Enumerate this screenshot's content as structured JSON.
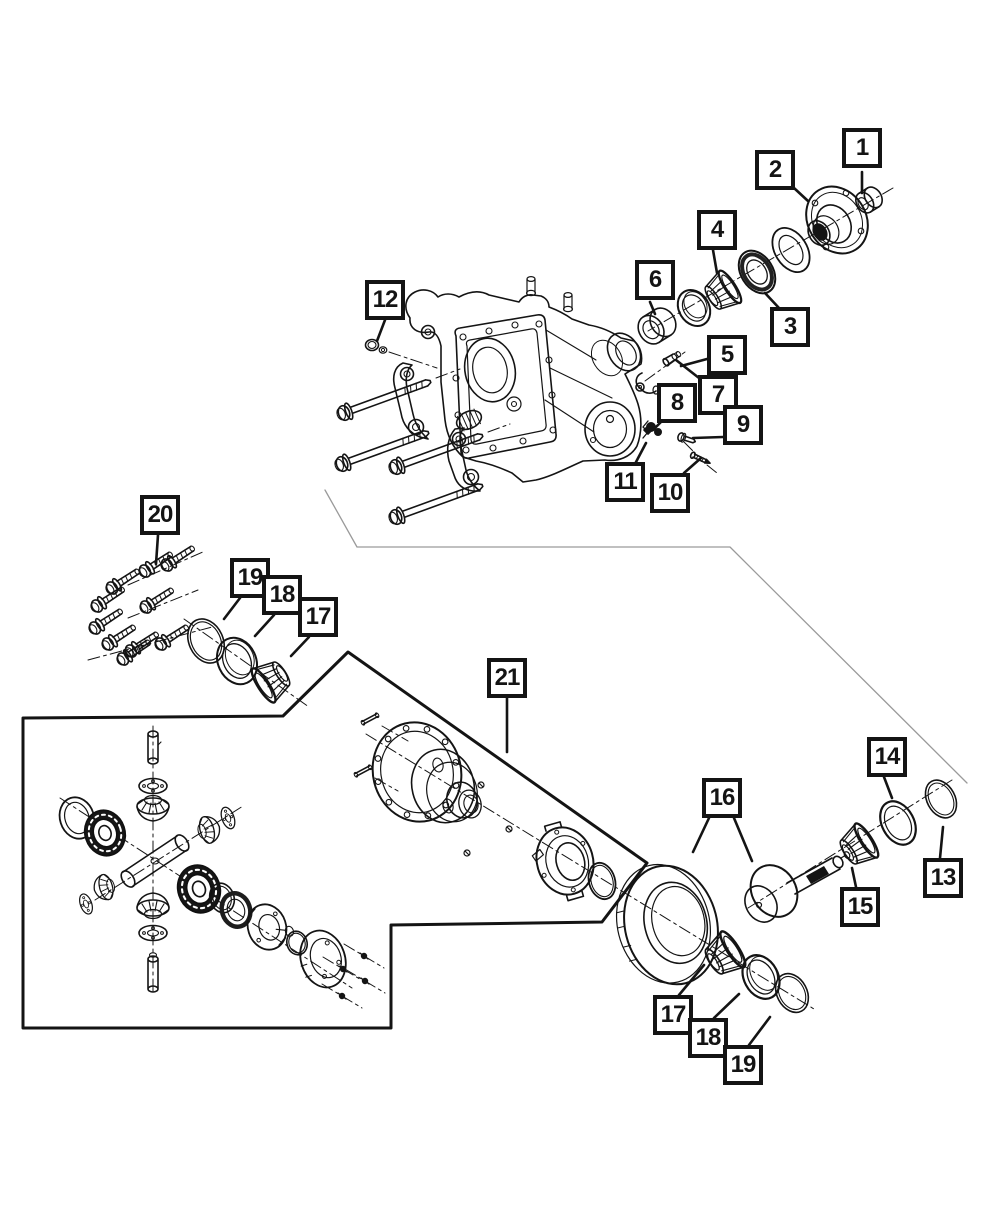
{
  "diagram": {
    "type": "exploded-parts-diagram",
    "canvas": {
      "width": 1000,
      "height": 1214
    },
    "colors": {
      "paper": "#ffffff",
      "ink": "#141414",
      "divider": "#9a9a9a"
    },
    "callout_numbers_visible": [
      "1",
      "2",
      "3",
      "4",
      "5",
      "6",
      "7",
      "8",
      "9",
      "10",
      "11",
      "12",
      "13",
      "14",
      "15",
      "16",
      "17",
      "18",
      "19",
      "20",
      "21"
    ],
    "callouts": [
      {
        "id": "12",
        "label": "12",
        "box": [
          365,
          280
        ],
        "leaders": [
          [
            [
              385,
              320
            ],
            [
              377,
              341
            ]
          ]
        ]
      },
      {
        "id": "1",
        "label": "1",
        "box": [
          842,
          128
        ],
        "leaders": [
          [
            [
              862,
              172
            ],
            [
              862,
              193
            ]
          ]
        ]
      },
      {
        "id": "2",
        "label": "2",
        "box": [
          755,
          150
        ],
        "leaders": [
          [
            [
              794,
              188
            ],
            [
              808,
              201
            ]
          ]
        ]
      },
      {
        "id": "4",
        "label": "4",
        "box": [
          697,
          210
        ],
        "leaders": [
          [
            [
              713,
              250
            ],
            [
              717,
              273
            ]
          ]
        ]
      },
      {
        "id": "6",
        "label": "6",
        "box": [
          635,
          260
        ],
        "leaders": [
          [
            [
              650,
              302
            ],
            [
              655,
              314
            ]
          ]
        ]
      },
      {
        "id": "3",
        "label": "3",
        "box": [
          770,
          307
        ],
        "leaders": [
          [
            [
              779,
              308
            ],
            [
              765,
              293
            ]
          ]
        ]
      },
      {
        "id": "5",
        "label": "5",
        "box": [
          707,
          335
        ],
        "leaders": [
          [
            [
              707,
              359
            ],
            [
              681,
              366
            ]
          ]
        ]
      },
      {
        "id": "7",
        "label": "7",
        "box": [
          698,
          375
        ],
        "leaders": [
          [
            [
              699,
              378
            ],
            [
              676,
              360
            ]
          ]
        ]
      },
      {
        "id": "8",
        "label": "8",
        "box": [
          657,
          383
        ],
        "leaders": [
          [
            [
              661,
              422
            ],
            [
              654,
              429
            ]
          ]
        ]
      },
      {
        "id": "9",
        "label": "9",
        "box": [
          723,
          405
        ],
        "leaders": [
          [
            [
              723,
              437
            ],
            [
              693,
              438
            ]
          ]
        ]
      },
      {
        "id": "11",
        "label": "11",
        "box": [
          605,
          462
        ],
        "leaders": [
          [
            [
              636,
              462
            ],
            [
              646,
              443
            ]
          ]
        ]
      },
      {
        "id": "10",
        "label": "10",
        "box": [
          650,
          473
        ],
        "leaders": [
          [
            [
              684,
              473
            ],
            [
              701,
              458
            ]
          ]
        ]
      },
      {
        "id": "20",
        "label": "20",
        "box": [
          140,
          495
        ],
        "leaders": [
          [
            [
              158,
              535
            ],
            [
              156,
              564
            ]
          ]
        ]
      },
      {
        "id": "19-left",
        "label": "19",
        "box": [
          230,
          558
        ],
        "leaders": [
          [
            [
              240,
              598
            ],
            [
              224,
              619
            ]
          ]
        ]
      },
      {
        "id": "18-left",
        "label": "18",
        "box": [
          262,
          575
        ],
        "leaders": [
          [
            [
              274,
              615
            ],
            [
              255,
              636
            ]
          ]
        ]
      },
      {
        "id": "17-left",
        "label": "17",
        "box": [
          298,
          597
        ],
        "leaders": [
          [
            [
              309,
              637
            ],
            [
              291,
              656
            ]
          ]
        ]
      },
      {
        "id": "21",
        "label": "21",
        "box": [
          487,
          658
        ],
        "leaders": [
          [
            [
              507,
              698
            ],
            [
              507,
              752
            ]
          ]
        ]
      },
      {
        "id": "16",
        "label": "16",
        "box": [
          702,
          778
        ],
        "leaders": [
          [
            [
              709,
              818
            ],
            [
              693,
              852
            ]
          ],
          [
            [
              734,
              818
            ],
            [
              752,
              861
            ]
          ]
        ]
      },
      {
        "id": "14",
        "label": "14",
        "box": [
          867,
          737
        ],
        "leaders": [
          [
            [
              884,
              777
            ],
            [
              892,
              798
            ]
          ]
        ]
      },
      {
        "id": "13",
        "label": "13",
        "box": [
          923,
          858
        ],
        "leaders": [
          [
            [
              940,
              858
            ],
            [
              943,
              827
            ]
          ]
        ]
      },
      {
        "id": "15",
        "label": "15",
        "box": [
          840,
          887
        ],
        "leaders": [
          [
            [
              856,
              887
            ],
            [
              852,
              868
            ]
          ]
        ]
      },
      {
        "id": "17-lower",
        "label": "17",
        "box": [
          653,
          995
        ],
        "leaders": [
          [
            [
              679,
              995
            ],
            [
              704,
              965
            ]
          ]
        ]
      },
      {
        "id": "18-lower",
        "label": "18",
        "box": [
          688,
          1018
        ],
        "leaders": [
          [
            [
              714,
              1018
            ],
            [
              739,
              994
            ]
          ]
        ]
      },
      {
        "id": "19-lower",
        "label": "19",
        "box": [
          723,
          1045
        ],
        "leaders": [
          [
            [
              749,
              1045
            ],
            [
              770,
              1017
            ]
          ]
        ]
      }
    ]
  }
}
